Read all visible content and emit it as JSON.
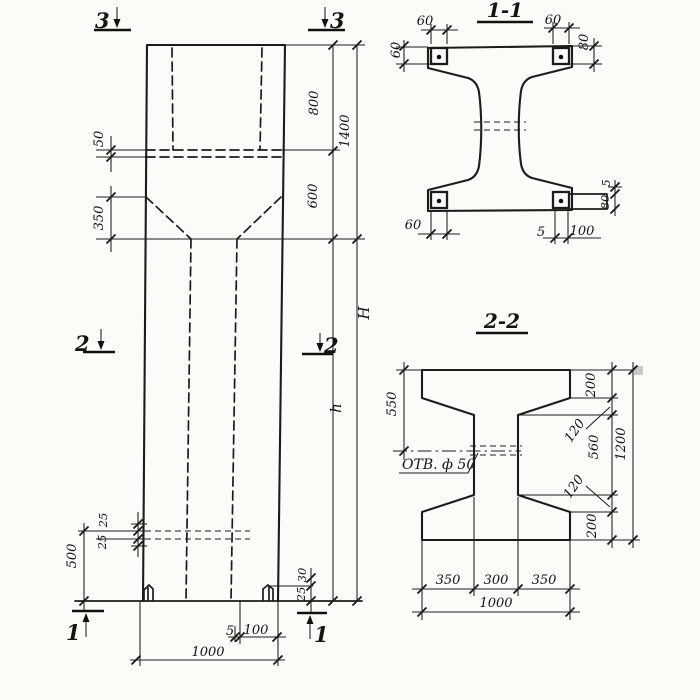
{
  "colors": {
    "ink": "#1c1c1c",
    "paper": "#fbfbf8"
  },
  "elevation": {
    "marker_3_left": "3",
    "marker_3_right": "3",
    "marker_2_left": "2",
    "marker_2_right": "2",
    "marker_1_left": "1",
    "marker_1_right": "1",
    "dim_ledge": "50",
    "dim_taper": "350",
    "dim_hole_upper": "25",
    "dim_hole_lower": "25",
    "dim_bottom_to_hole": "500",
    "dim_key_height": "30",
    "dim_key_depth": "25",
    "dim_gap": "5",
    "dim_plate": "100",
    "dim_width": "1000",
    "dim_cap_top": "800",
    "dim_cap_bottom": "600",
    "dim_cap_total": "1400",
    "dim_total_height": "H",
    "dim_shaft_height": "h"
  },
  "section_1_1": {
    "title": "1-1",
    "dim_tl_h": "60",
    "dim_tl_v": "60",
    "dim_tr_h": "60",
    "dim_tr_v": "80",
    "dim_bl": "60",
    "dim_plate_gap": "5",
    "dim_plate_height": "80",
    "dim_b_gap": "5",
    "dim_b_plate": "100"
  },
  "section_2_2": {
    "title": "2-2",
    "dim_top_to_hole": "550",
    "dim_flange_top": "200",
    "dim_taper_top": "120",
    "dim_web": "560",
    "dim_taper_bottom": "120",
    "dim_flange_bottom": "200",
    "dim_total": "1200",
    "dim_left": "350",
    "dim_mid": "300",
    "dim_right": "350",
    "dim_width": "1000",
    "hole_label": "ОТВ. ф 50"
  }
}
